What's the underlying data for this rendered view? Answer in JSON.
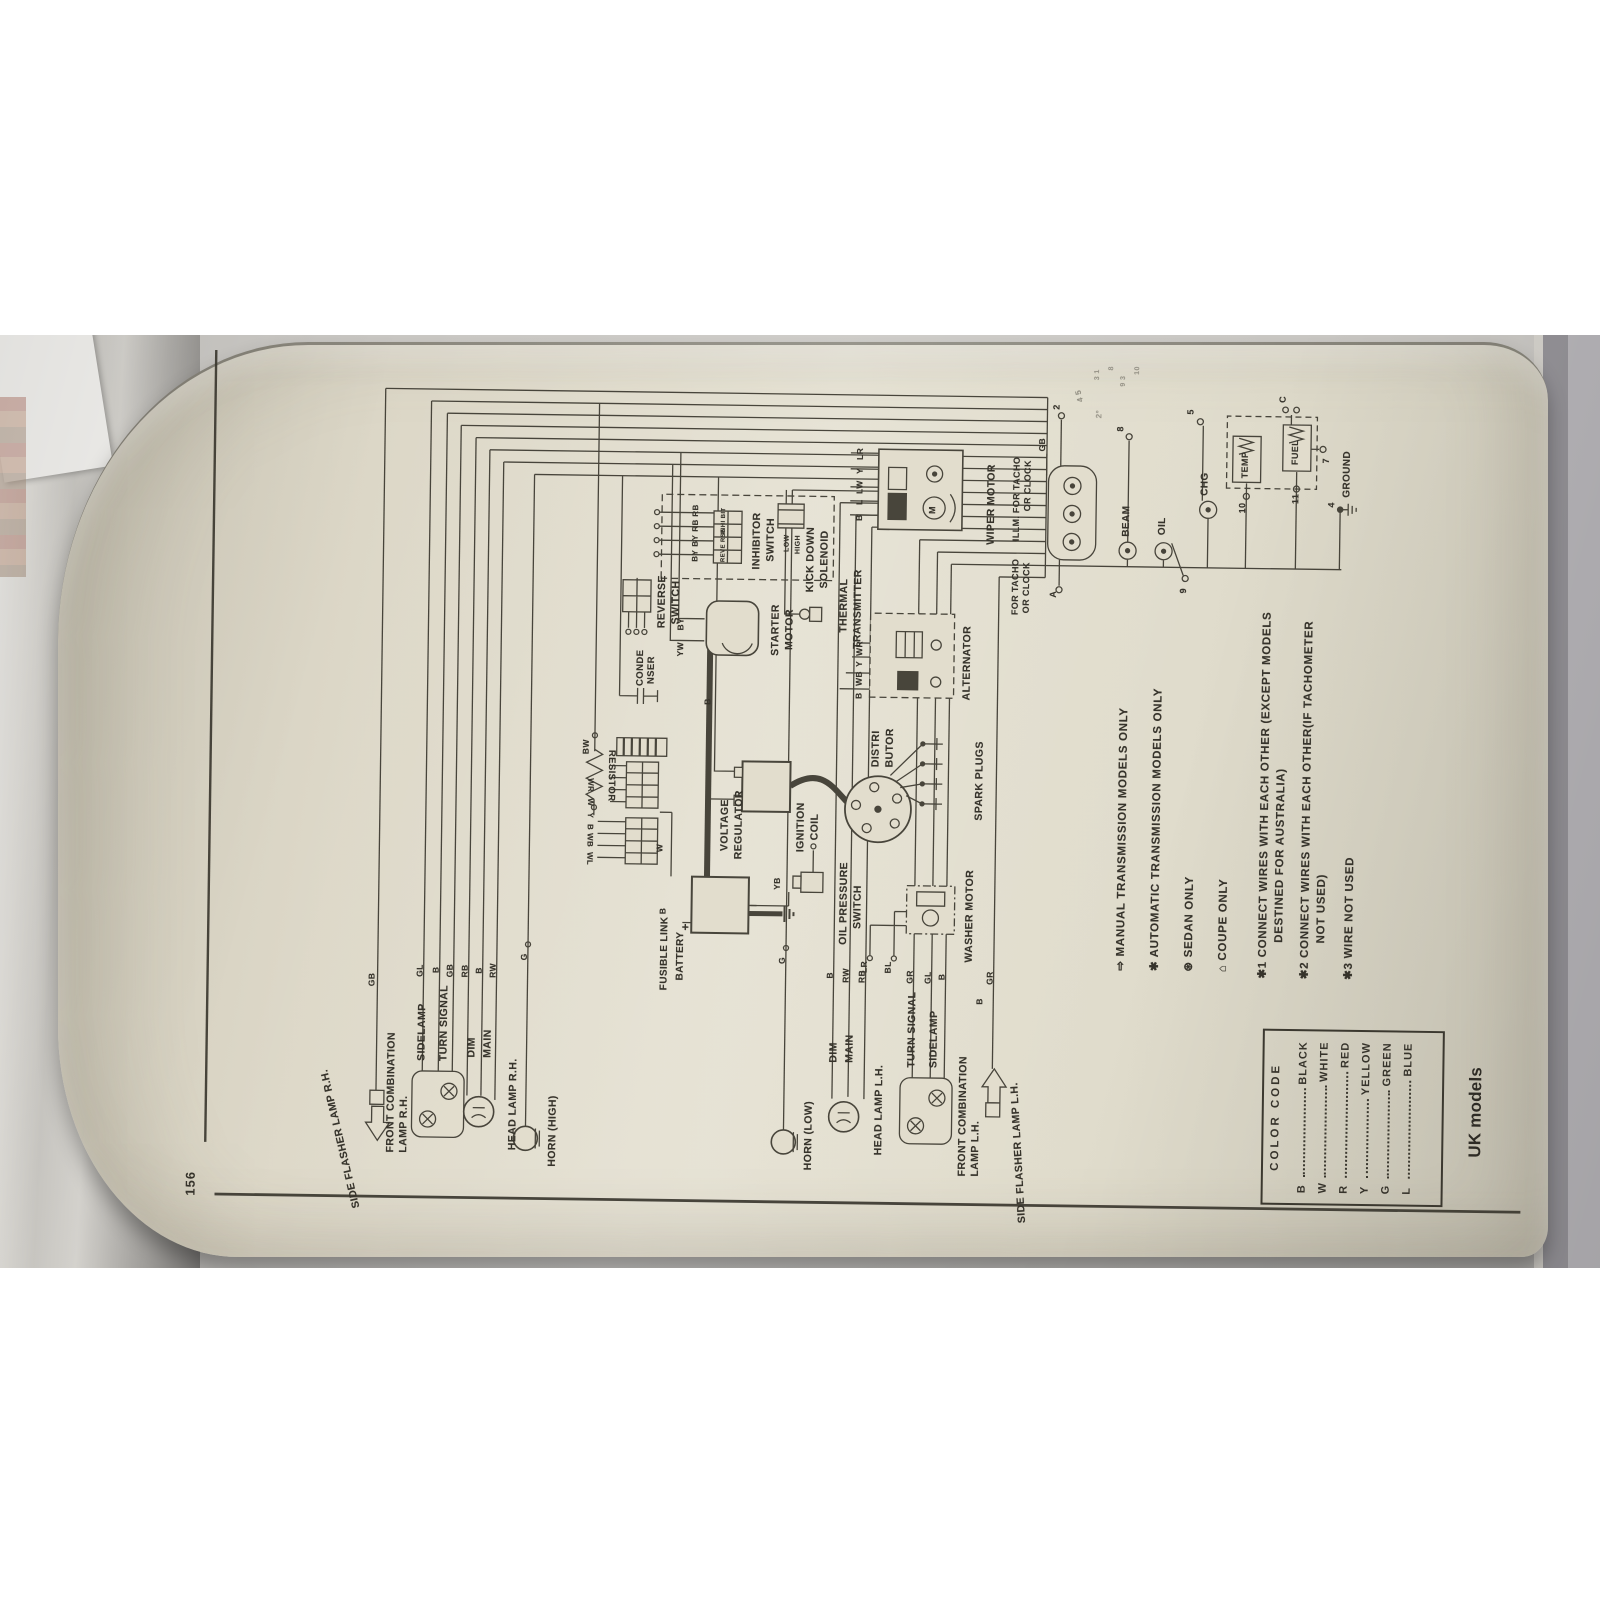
{
  "page": {
    "number": "156",
    "caption": "UK models"
  },
  "diagram": {
    "color_code": {
      "title": "COLOR CODE",
      "entries": [
        {
          "code": "B",
          "name": "BLACK"
        },
        {
          "code": "W",
          "name": "WHITE"
        },
        {
          "code": "R",
          "name": "RED"
        },
        {
          "code": "Y",
          "name": "YELLOW"
        },
        {
          "code": "G",
          "name": "GREEN"
        },
        {
          "code": "L",
          "name": "BLUE"
        }
      ]
    },
    "notes": [
      {
        "marker": "⇨",
        "text": "MANUAL TRANSMISSION MODELS ONLY",
        "x": 288,
        "y": 928
      },
      {
        "marker": "✱",
        "text": "AUTOMATIC TRANSMISSION MODELS ONLY",
        "x": 288,
        "y": 962
      },
      {
        "marker": "⊛",
        "text": "SEDAN ONLY",
        "x": 288,
        "y": 996
      },
      {
        "marker": "⌂",
        "text": "COUPE ONLY",
        "x": 288,
        "y": 1030
      },
      {
        "marker": "✱1",
        "text": "CONNECT WIRES WITH EACH OTHER (EXCEPT MODELS",
        "x": 282,
        "y": 1070
      },
      {
        "marker": "",
        "text": "DESTINED FOR AUSTRALIA)",
        "x": 318,
        "y": 1086
      },
      {
        "marker": "✱2",
        "text": "CONNECT WIRES WITH EACH OTHER(IF TACHOMETER",
        "x": 282,
        "y": 1112
      },
      {
        "marker": "",
        "text": "NOT USED)",
        "x": 318,
        "y": 1128
      },
      {
        "marker": "✱3",
        "text": "WIRE NOT USED",
        "x": 282,
        "y": 1156
      }
    ],
    "labels": [
      {
        "n": "side-flasher-rh-label",
        "t": "SIDE FLASHER LAMP R.H.",
        "x": 38,
        "y": 150,
        "r": -14
      },
      {
        "n": "wire-gb-1",
        "t": "GB",
        "x": 262,
        "y": 180,
        "s": 8.5
      },
      {
        "n": "front-combination-rh-label-1",
        "t": "FRONT COMBINATION",
        "x": 96,
        "y": 200
      },
      {
        "n": "front-combination-rh-label-2",
        "t": "LAMP R.H.",
        "x": 96,
        "y": 213
      },
      {
        "n": "sidelamp-rh-label",
        "t": "SIDELAMP",
        "x": 188,
        "y": 230
      },
      {
        "n": "turn-signal-rh-label",
        "t": "TURN SIGNAL",
        "x": 188,
        "y": 252
      },
      {
        "n": "wire-gl-1",
        "t": "GL",
        "x": 272,
        "y": 228,
        "s": 8.5
      },
      {
        "n": "wire-b-1",
        "t": "B",
        "x": 276,
        "y": 244,
        "s": 8.5
      },
      {
        "n": "wire-gb-2",
        "t": "GB",
        "x": 272,
        "y": 258,
        "s": 8.5
      },
      {
        "n": "dim-rh-label",
        "t": "DIM",
        "x": 192,
        "y": 280
      },
      {
        "n": "main-rh-label",
        "t": "MAIN",
        "x": 192,
        "y": 296
      },
      {
        "n": "wire-rb-1",
        "t": "RB",
        "x": 272,
        "y": 273,
        "s": 8.5
      },
      {
        "n": "wire-b-2",
        "t": "B",
        "x": 276,
        "y": 287,
        "s": 8.5
      },
      {
        "n": "wire-rw-1",
        "t": "RW",
        "x": 272,
        "y": 301,
        "s": 8.5
      },
      {
        "n": "head-lamp-rh-label",
        "t": "HEAD LAMP R.H.",
        "x": 100,
        "y": 322
      },
      {
        "n": "horn-high-label",
        "t": "HORN (HIGH)",
        "x": 84,
        "y": 362
      },
      {
        "n": "wire-g-1",
        "t": "G",
        "x": 290,
        "y": 332,
        "s": 8.5
      },
      {
        "n": "horn-low-label",
        "t": "HORN (LOW)",
        "x": 84,
        "y": 618
      },
      {
        "n": "wire-g-2",
        "t": "G",
        "x": 290,
        "y": 590,
        "s": 8.5
      },
      {
        "n": "dim-lh-label",
        "t": "DIM",
        "x": 192,
        "y": 642
      },
      {
        "n": "main-lh-label",
        "t": "MAIN",
        "x": 192,
        "y": 658
      },
      {
        "n": "wire-b-3",
        "t": "B",
        "x": 276,
        "y": 638,
        "s": 8.5
      },
      {
        "n": "wire-rw-2",
        "t": "RW",
        "x": 272,
        "y": 654,
        "s": 8.5
      },
      {
        "n": "wire-rb-2",
        "t": "RB",
        "x": 272,
        "y": 670,
        "s": 8.5
      },
      {
        "n": "head-lamp-lh-label",
        "t": "HEAD LAMP L.H.",
        "x": 100,
        "y": 688
      },
      {
        "n": "turn-signal-lh-label",
        "t": "TURN SIGNAL",
        "x": 188,
        "y": 720
      },
      {
        "n": "sidelamp-lh-label",
        "t": "SIDELAMP",
        "x": 188,
        "y": 742
      },
      {
        "n": "wire-gr-1",
        "t": "GR",
        "x": 272,
        "y": 718,
        "s": 8.5
      },
      {
        "n": "wire-gl-2",
        "t": "GL",
        "x": 272,
        "y": 736,
        "s": 8.5
      },
      {
        "n": "wire-b-4",
        "t": "B",
        "x": 276,
        "y": 750,
        "s": 8.5
      },
      {
        "n": "front-combination-lh-label-1",
        "t": "FRONT COMBINATION",
        "x": 80,
        "y": 772
      },
      {
        "n": "front-combination-lh-label-2",
        "t": "LAMP L.H.",
        "x": 80,
        "y": 785
      },
      {
        "n": "wire-b-5",
        "t": "B",
        "x": 252,
        "y": 788,
        "s": 8.5
      },
      {
        "n": "wire-gr-2",
        "t": "GR",
        "x": 272,
        "y": 798,
        "s": 8.5
      },
      {
        "n": "side-flasher-lh-label",
        "t": "SIDE FLASHER LAMP L.H.",
        "x": 34,
        "y": 828,
        "r": -4
      },
      {
        "n": "fusible-link-label",
        "t": "FUSIBLE LINK",
        "x": 262,
        "y": 472,
        "s": 10
      },
      {
        "n": "battery-label",
        "t": "BATTERY",
        "x": 272,
        "y": 488,
        "s": 10
      },
      {
        "n": "battery-plus-label",
        "t": "+",
        "x": 322,
        "y": 491,
        "s": 12
      },
      {
        "n": "wire-b-6",
        "t": "B",
        "x": 338,
        "y": 470,
        "s": 8.5
      },
      {
        "n": "wire-w-1",
        "t": "W",
        "x": 400,
        "y": 466,
        "s": 8.5
      },
      {
        "n": "wire-yb",
        "t": "YB",
        "x": 364,
        "y": 584,
        "s": 8.5
      },
      {
        "n": "voltage-regulator-label-1",
        "t": "VOLTAGE",
        "x": 402,
        "y": 530
      },
      {
        "n": "voltage-regulator-label-2",
        "t": "REGULATOR",
        "x": 394,
        "y": 544
      },
      {
        "n": "wire-wl",
        "t": "WL",
        "x": 386,
        "y": 396,
        "s": 8,
        "r": 180
      },
      {
        "n": "wire-wb-1",
        "t": "WB",
        "x": 404,
        "y": 396,
        "s": 8,
        "r": 180
      },
      {
        "n": "wire-b-7",
        "t": "B",
        "x": 421,
        "y": 396,
        "s": 8,
        "r": 180
      },
      {
        "n": "wire-y-1",
        "t": "Y",
        "x": 433,
        "y": 396,
        "s": 8,
        "r": 180
      },
      {
        "n": "wire-w-2",
        "t": "W",
        "x": 445,
        "y": 396,
        "s": 8,
        "r": 180
      },
      {
        "n": "wire-wr-1",
        "t": "WR",
        "x": 459,
        "y": 396,
        "s": 8,
        "r": 180
      },
      {
        "n": "resistor-label",
        "t": "RESISTOR",
        "x": 450,
        "y": 416,
        "s": 9.5,
        "r": 180
      },
      {
        "n": "wire-bw",
        "t": "BW",
        "x": 497,
        "y": 391,
        "s": 8.5
      },
      {
        "n": "condenser-label-1",
        "t": "CONDE",
        "x": 566,
        "y": 444,
        "s": 9.5
      },
      {
        "n": "condenser-label-2",
        "t": "NSER",
        "x": 568,
        "y": 455,
        "s": 9.5
      },
      {
        "n": "ignition-coil-label-1",
        "t": "IGNITION",
        "x": 402,
        "y": 606
      },
      {
        "n": "ignition-coil-label-2",
        "t": "COIL",
        "x": 414,
        "y": 620
      },
      {
        "n": "wire-b-8",
        "t": "B",
        "x": 548,
        "y": 512,
        "s": 8.5
      },
      {
        "n": "distributor-label-1",
        "t": "DISTRI",
        "x": 488,
        "y": 680
      },
      {
        "n": "distributor-label-2",
        "t": "BUTOR",
        "x": 488,
        "y": 694
      },
      {
        "n": "spark-plugs-label",
        "t": "SPARK PLUGS",
        "x": 436,
        "y": 784
      },
      {
        "n": "oil-pressure-label-1",
        "t": "OIL PRESSURE",
        "x": 310,
        "y": 650
      },
      {
        "n": "oil-pressure-label-2",
        "t": "SWITCH",
        "x": 326,
        "y": 664
      },
      {
        "n": "wire-lr-1",
        "t": "LR",
        "x": 282,
        "y": 672,
        "s": 8.5
      },
      {
        "n": "wire-bl",
        "t": "BL",
        "x": 282,
        "y": 696,
        "s": 8.5
      },
      {
        "n": "washer-motor-label",
        "t": "WASHER MOTOR",
        "x": 294,
        "y": 776
      },
      {
        "n": "starter-motor-label-1",
        "t": "STARTER",
        "x": 598,
        "y": 578
      },
      {
        "n": "starter-motor-label-2",
        "t": "MOTOR",
        "x": 604,
        "y": 592
      },
      {
        "n": "wire-yw",
        "t": "YW",
        "x": 596,
        "y": 484,
        "s": 8.5
      },
      {
        "n": "wire-by-0",
        "t": "BY",
        "x": 622,
        "y": 484,
        "s": 8.5
      },
      {
        "n": "thermal-label-1",
        "t": "THERMAL",
        "x": 622,
        "y": 646
      },
      {
        "n": "thermal-label-2",
        "t": "TRANSMITTER",
        "x": 606,
        "y": 660
      },
      {
        "n": "alternator-label",
        "t": "ALTERNATOR",
        "x": 556,
        "y": 770
      },
      {
        "n": "wire-b-9",
        "t": "B",
        "x": 556,
        "y": 663,
        "s": 8.5
      },
      {
        "n": "wire-wb-2",
        "t": "WB",
        "x": 569,
        "y": 663,
        "s": 8.5
      },
      {
        "n": "wire-y-2",
        "t": "Y",
        "x": 588,
        "y": 663,
        "s": 8.5
      },
      {
        "n": "wire-wr-2",
        "t": "WR",
        "x": 599,
        "y": 663,
        "s": 8.5
      },
      {
        "n": "reverse-switch-label-1",
        "t": "REVERSE",
        "x": 624,
        "y": 464
      },
      {
        "n": "reverse-switch-label-2",
        "t": "SWITCH",
        "x": 628,
        "y": 478
      },
      {
        "n": "inhibitor-wire-by-1",
        "t": "BY",
        "x": 691,
        "y": 498,
        "s": 8
      },
      {
        "n": "inhibitor-wire-by-2",
        "t": "BY",
        "x": 706,
        "y": 498,
        "s": 8
      },
      {
        "n": "inhibitor-wire-rb-1",
        "t": "RB",
        "x": 721,
        "y": 498,
        "s": 8
      },
      {
        "n": "inhibitor-wire-rb-2",
        "t": "RB",
        "x": 736,
        "y": 498,
        "s": 8
      },
      {
        "n": "connector-reverse-label",
        "t": "REVE RSE",
        "x": 691,
        "y": 527,
        "s": 6
      },
      {
        "n": "connector-inhibit-label",
        "t": "INHI BIT",
        "x": 719,
        "y": 527,
        "s": 6
      },
      {
        "n": "inhibitor-switch-label-1",
        "t": "INHIBITOR",
        "x": 684,
        "y": 558
      },
      {
        "n": "inhibitor-switch-label-2",
        "t": "SWITCH",
        "x": 692,
        "y": 572
      },
      {
        "n": "kickdown-low-label",
        "t": "LOW",
        "x": 702,
        "y": 590,
        "s": 7
      },
      {
        "n": "kickdown-high-label",
        "t": "HIGH",
        "x": 700,
        "y": 601,
        "s": 7
      },
      {
        "n": "kick-down-label-1",
        "t": "KICK DOWN",
        "x": 662,
        "y": 612
      },
      {
        "n": "kick-down-label-2",
        "t": "SOLENOID",
        "x": 666,
        "y": 626
      },
      {
        "n": "wiper-motor-label",
        "t": "WIPER MOTOR",
        "x": 712,
        "y": 792
      },
      {
        "n": "wiper-m-label",
        "t": "M",
        "x": 742,
        "y": 734,
        "s": 9
      },
      {
        "n": "wire-b-10",
        "t": "B",
        "x": 734,
        "y": 661,
        "s": 8.5
      },
      {
        "n": "wire-l",
        "t": "L",
        "x": 750,
        "y": 661,
        "s": 8.5
      },
      {
        "n": "wire-lw",
        "t": "LW",
        "x": 761,
        "y": 661,
        "s": 8.5
      },
      {
        "n": "wire-y-3",
        "t": "Y",
        "x": 781,
        "y": 661,
        "s": 8.5
      },
      {
        "n": "wire-lr-2",
        "t": "LR",
        "x": 795,
        "y": 661,
        "s": 8.5
      },
      {
        "n": "for-tacho-1a",
        "t": "FOR TACHO",
        "x": 642,
        "y": 818,
        "s": 9
      },
      {
        "n": "for-tacho-1b",
        "t": "OR CLOCK",
        "x": 644,
        "y": 829,
        "s": 9
      },
      {
        "n": "illm-label",
        "t": "ILLM.",
        "x": 716,
        "y": 818,
        "s": 9
      },
      {
        "n": "for-tacho-2a",
        "t": "FOR TACHO",
        "x": 744,
        "y": 818,
        "s": 9
      },
      {
        "n": "for-tacho-2b",
        "t": "OR CLOCK",
        "x": 746,
        "y": 829,
        "s": 9
      },
      {
        "n": "terminal-a",
        "t": "A",
        "x": 660,
        "y": 856,
        "s": 9
      },
      {
        "n": "terminal-gb",
        "t": "GB",
        "x": 806,
        "y": 843,
        "s": 8.5
      },
      {
        "n": "terminal-2",
        "t": "2",
        "x": 848,
        "y": 857,
        "s": 9
      },
      {
        "n": "beam-label",
        "t": "BEAM",
        "x": 722,
        "y": 928,
        "s": 10
      },
      {
        "n": "terminal-8",
        "t": "8",
        "x": 827,
        "y": 921,
        "s": 9
      },
      {
        "n": "oil-label",
        "t": "OIL",
        "x": 724,
        "y": 964,
        "s": 10
      },
      {
        "n": "terminal-9",
        "t": "9",
        "x": 666,
        "y": 986,
        "s": 9
      },
      {
        "n": "chg-label",
        "t": "CHG",
        "x": 764,
        "y": 1006,
        "s": 10
      },
      {
        "n": "terminal-5",
        "t": "5",
        "x": 845,
        "y": 991,
        "s": 9
      },
      {
        "n": "temp-label",
        "t": "TEMP",
        "x": 782,
        "y": 1046,
        "s": 9
      },
      {
        "n": "terminal-10",
        "t": "10",
        "x": 747,
        "y": 1044,
        "s": 9
      },
      {
        "n": "fuel-label",
        "t": "FUEL",
        "x": 796,
        "y": 1096,
        "s": 9
      },
      {
        "n": "terminal-11",
        "t": "11",
        "x": 757,
        "y": 1097,
        "s": 9
      },
      {
        "n": "terminal-7",
        "t": "7",
        "x": 798,
        "y": 1127,
        "s": 9
      },
      {
        "n": "terminal-c",
        "t": "C",
        "x": 858,
        "y": 1083,
        "s": 9
      },
      {
        "n": "terminal-4",
        "t": "4",
        "x": 754,
        "y": 1133,
        "s": 9
      },
      {
        "n": "ground-label",
        "t": "GROUND",
        "x": 764,
        "y": 1148,
        "s": 10
      },
      {
        "n": "faint-mark-45",
        "t": "4 5",
        "x": 856,
        "y": 880,
        "s": 8,
        "o": 0.45,
        "r": -15
      },
      {
        "n": "faint-mark-2deg",
        "t": "2°",
        "x": 840,
        "y": 900,
        "s": 8,
        "o": 0.4
      },
      {
        "n": "faint-mark-31",
        "t": "3 1",
        "x": 878,
        "y": 898,
        "s": 7,
        "o": 0.4
      },
      {
        "n": "faint-mark-8",
        "t": "8",
        "x": 888,
        "y": 912,
        "s": 7,
        "o": 0.4
      },
      {
        "n": "faint-mark-93",
        "t": "9 3",
        "x": 872,
        "y": 924,
        "s": 7,
        "o": 0.4
      },
      {
        "n": "faint-mark-10",
        "t": "10",
        "x": 884,
        "y": 938,
        "s": 7,
        "o": 0.4
      }
    ]
  }
}
